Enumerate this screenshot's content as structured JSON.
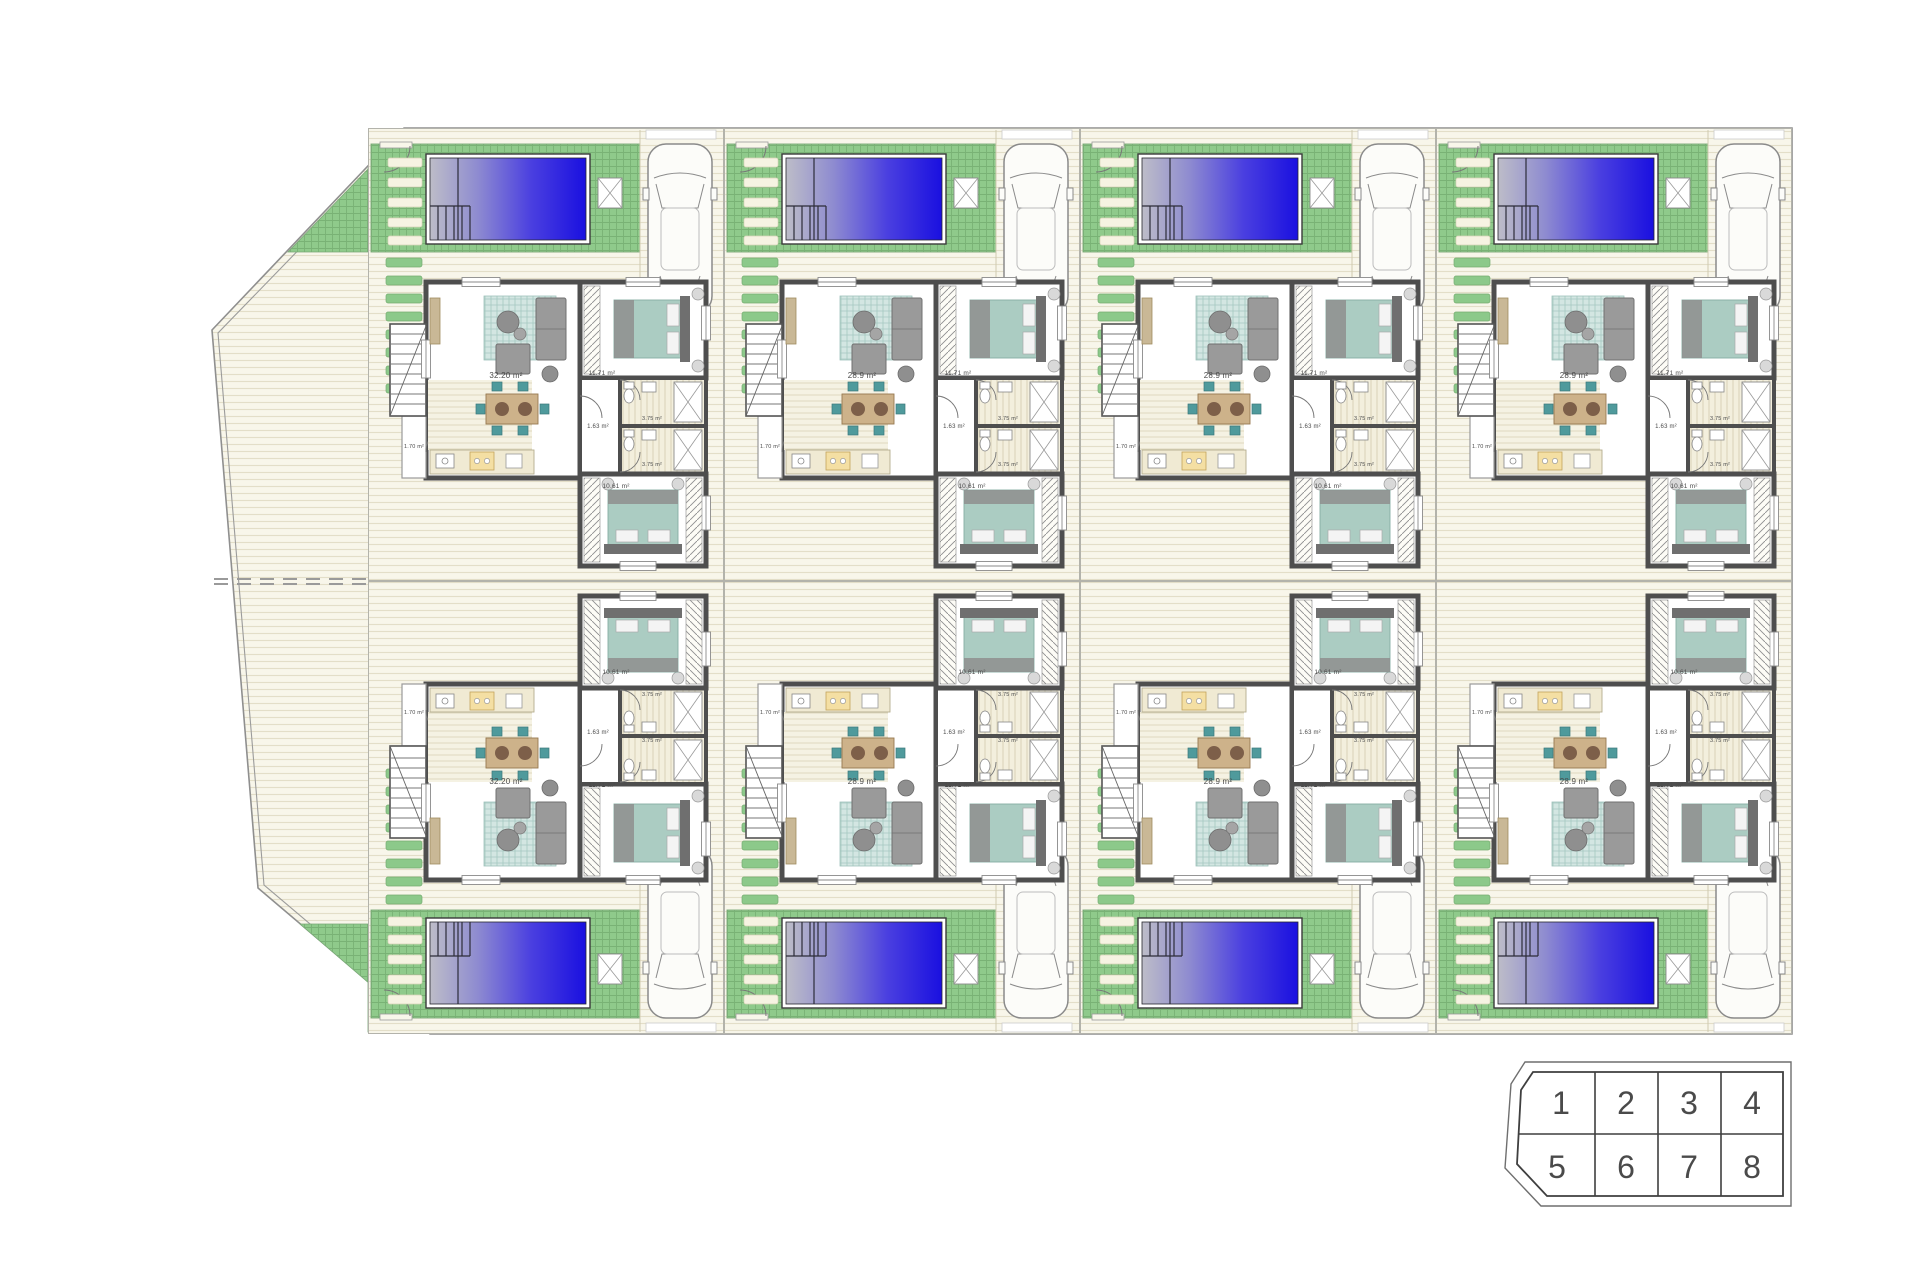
{
  "site": {
    "name": "residential-site-plan",
    "rows": 2,
    "cols": 4
  },
  "units": [
    {
      "plot": "1",
      "rooms": {
        "living": "32.20 m²",
        "bedroom_top": "11.71 m²",
        "bedroom_bottom": "10.61 m²",
        "bath_a": "3.75 m²",
        "bath_b": "3.75 m²",
        "hall": "1.63 m²",
        "porch": "1.70 m²"
      }
    },
    {
      "plot": "2",
      "rooms": {
        "living": "28.9 m²",
        "bedroom_top": "11.71 m²",
        "bedroom_bottom": "10.61 m²",
        "bath_a": "3.75 m²",
        "bath_b": "3.75 m²",
        "hall": "1.63 m²",
        "porch": "1.70 m²"
      }
    },
    {
      "plot": "3",
      "rooms": {
        "living": "28.9 m²",
        "bedroom_top": "11.71 m²",
        "bedroom_bottom": "10.61 m²",
        "bath_a": "3.75 m²",
        "bath_b": "3.75 m²",
        "hall": "1.63 m²",
        "porch": "1.70 m²"
      }
    },
    {
      "plot": "4",
      "rooms": {
        "living": "28.9 m²",
        "bedroom_top": "11.71 m²",
        "bedroom_bottom": "10.61 m²",
        "bath_a": "3.75 m²",
        "bath_b": "3.75 m²",
        "hall": "1.63 m²",
        "porch": "1.70 m²"
      }
    },
    {
      "plot": "5",
      "rooms": {
        "living": "32.20 m²",
        "bedroom_top": "11.71 m²",
        "bedroom_bottom": "10.61 m²",
        "bath_a": "3.75 m²",
        "bath_b": "3.75 m²",
        "hall": "1.63 m²",
        "porch": "1.70 m²"
      }
    },
    {
      "plot": "6",
      "rooms": {
        "living": "28.9 m²",
        "bedroom_top": "11.71 m²",
        "bedroom_bottom": "10.61 m²",
        "bath_a": "3.75 m²",
        "bath_b": "3.75 m²",
        "hall": "1.63 m²",
        "porch": "1.70 m²"
      }
    },
    {
      "plot": "7",
      "rooms": {
        "living": "28.9 m²",
        "bedroom_top": "11.71 m²",
        "bedroom_bottom": "10.61 m²",
        "bath_a": "3.75 m²",
        "bath_b": "3.75 m²",
        "hall": "1.63 m²",
        "porch": "1.70 m²"
      }
    },
    {
      "plot": "8",
      "rooms": {
        "living": "28.9 m²",
        "bedroom_top": "11.71 m²",
        "bedroom_bottom": "10.61 m²",
        "bath_a": "3.75 m²",
        "bath_b": "3.75 m²",
        "hall": "1.63 m²",
        "porch": "1.70 m²"
      }
    }
  ],
  "legend": {
    "cells": [
      "1",
      "2",
      "3",
      "4",
      "5",
      "6",
      "7",
      "8"
    ]
  },
  "colors": {
    "pool_deep": "#1a10e0",
    "pool_mid": "#4a3fe0",
    "pool_light": "#bdbdc8",
    "garden": "#8fca8b",
    "stone": "#8cc98a",
    "stripe_bg": "#f8f6ea",
    "wall": "#4e4e4e",
    "bed": "#abccc2",
    "rug": "#d3e6e2",
    "sofa": "#9a9a9a",
    "wood": "#cdb28a",
    "chair": "#4f9a9c",
    "kitchen": "#f4dfa3"
  }
}
